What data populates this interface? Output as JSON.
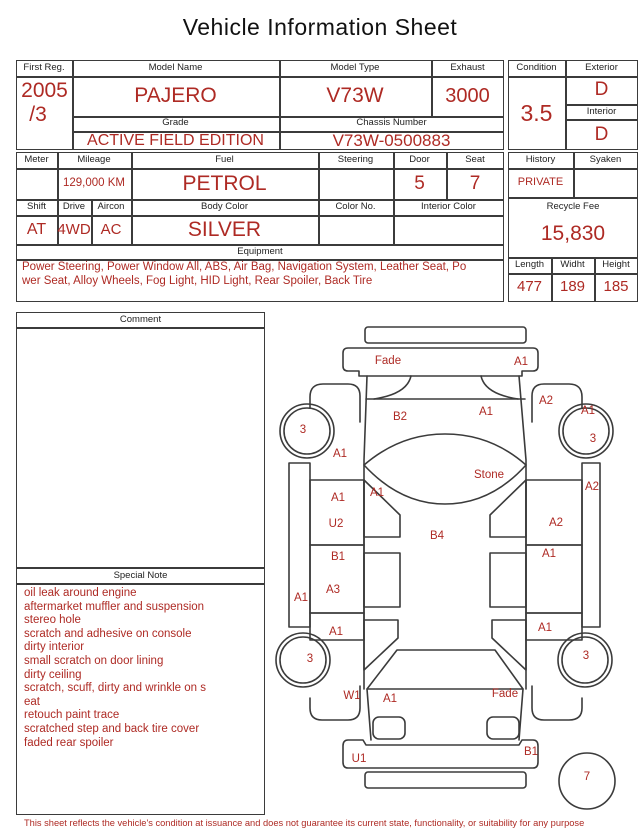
{
  "title": "Vehicle Information Sheet",
  "colors": {
    "accent": "#ae2a24",
    "line": "#3b3b3b"
  },
  "registration": {
    "first_reg_label": "First Reg.",
    "first_reg_year": "2005",
    "first_reg_month": "/3",
    "model_name_label": "Model Name",
    "model_name": "PAJERO",
    "model_type_label": "Model Type",
    "model_type": "V73W",
    "exhaust_label": "Exhaust",
    "exhaust": "3000",
    "grade_label": "Grade",
    "grade": "ACTIVE FIELD EDITION",
    "chassis_label": "Chassis Number",
    "chassis_number": "V73W-0500883"
  },
  "condition": {
    "label": "Condition",
    "score": "3.5",
    "exterior_label": "Exterior",
    "exterior": "D",
    "interior_label": "Interior",
    "interior": "D"
  },
  "specs": {
    "meter_label": "Meter",
    "meter": "",
    "mileage_label": "Mileage",
    "mileage": "129,000 KM",
    "fuel_label": "Fuel",
    "fuel": "PETROL",
    "steering_label": "Steering",
    "steering": "",
    "door_label": "Door",
    "door": "5",
    "seat_label": "Seat",
    "seat": "7",
    "shift_label": "Shift",
    "shift": "AT",
    "drive_label": "Drive",
    "drive": "4WD",
    "aircon_label": "Aircon",
    "aircon": "AC",
    "body_color_label": "Body Color",
    "body_color": "SILVER",
    "color_no_label": "Color No.",
    "color_no": "",
    "interior_color_label": "Interior Color",
    "interior_color": ""
  },
  "history": {
    "label": "History",
    "value": "PRIVATE",
    "syaken_label": "Syaken",
    "syaken": "",
    "recycle_label": "Recycle Fee",
    "recycle_fee": "15,830",
    "length_label": "Length",
    "length": "477",
    "width_label": "Widht",
    "width": "189",
    "height_label": "Height",
    "height": "185"
  },
  "equipment": {
    "label": "Equipment",
    "lines": [
      "Power Steering, Power Window  All, ABS, Air Bag, Navigation System, Leather Seat, Po",
      "wer Seat, Alloy Wheels, Fog Light, HID Light, Rear Spoiler, Back Tire"
    ]
  },
  "comment": {
    "label": "Comment",
    "text": ""
  },
  "special_note": {
    "label": "Special Note",
    "lines": [
      "oil leak around engine",
      "aftermarket muffler and suspension",
      "stereo hole",
      "scratch and adhesive on console",
      "dirty interior",
      "small scratch on door lining",
      "dirty ceiling",
      "scratch, scuff, dirty and wrinkle on s",
      "eat",
      "retouch paint trace",
      "scratched step and back tire cover",
      "faded rear spoiler"
    ]
  },
  "diagram": {
    "labels": [
      {
        "text": "Fade",
        "x": 118,
        "y": 50
      },
      {
        "text": "A1",
        "x": 251,
        "y": 51
      },
      {
        "text": "B2",
        "x": 130,
        "y": 106
      },
      {
        "text": "A1",
        "x": 216,
        "y": 101
      },
      {
        "text": "A2",
        "x": 276,
        "y": 90
      },
      {
        "text": "A1",
        "x": 318,
        "y": 100
      },
      {
        "text": "3",
        "x": 323,
        "y": 128
      },
      {
        "text": "3",
        "x": 33,
        "y": 119
      },
      {
        "text": "A1",
        "x": 70,
        "y": 143
      },
      {
        "text": "Stone",
        "x": 219,
        "y": 164
      },
      {
        "text": "A1",
        "x": 68,
        "y": 187
      },
      {
        "text": "A1",
        "x": 107,
        "y": 182
      },
      {
        "text": "U2",
        "x": 66,
        "y": 213
      },
      {
        "text": "A2",
        "x": 322,
        "y": 176
      },
      {
        "text": "A2",
        "x": 286,
        "y": 212
      },
      {
        "text": "B4",
        "x": 167,
        "y": 225
      },
      {
        "text": "B1",
        "x": 68,
        "y": 246
      },
      {
        "text": "A1",
        "x": 279,
        "y": 243
      },
      {
        "text": "A3",
        "x": 63,
        "y": 279
      },
      {
        "text": "A1",
        "x": 31,
        "y": 287
      },
      {
        "text": "A1",
        "x": 66,
        "y": 321
      },
      {
        "text": "A1",
        "x": 275,
        "y": 317
      },
      {
        "text": "3",
        "x": 40,
        "y": 348
      },
      {
        "text": "3",
        "x": 316,
        "y": 345
      },
      {
        "text": "W1",
        "x": 82,
        "y": 385
      },
      {
        "text": "A1",
        "x": 120,
        "y": 388
      },
      {
        "text": "Fade",
        "x": 235,
        "y": 383
      },
      {
        "text": "B1",
        "x": 261,
        "y": 441
      },
      {
        "text": "U1",
        "x": 89,
        "y": 448
      },
      {
        "text": "7",
        "x": 317,
        "y": 466
      }
    ]
  },
  "footer": "This sheet reflects the vehicle's condition at issuance and does not guarantee its current state, functionality, or suitability for any purpose"
}
